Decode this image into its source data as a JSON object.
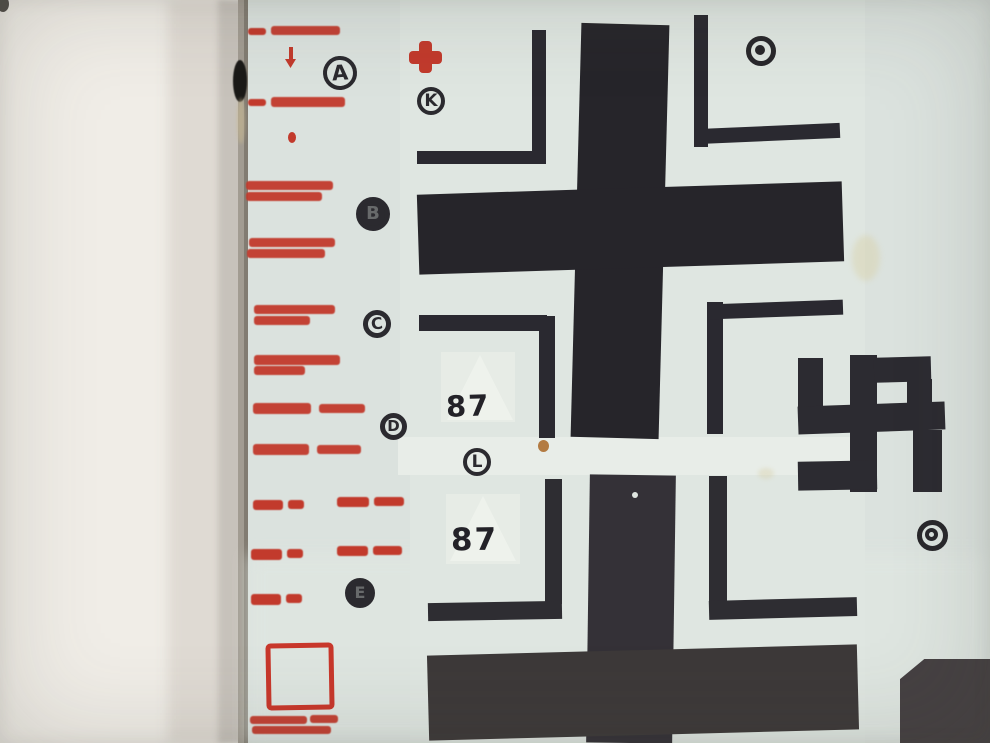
{
  "colors": {
    "wall": "#f0ede7",
    "wall_shadow": "#c7c2bb",
    "sheet_edge": "#a29c92",
    "sheet": "#dbe2de",
    "carrier_film": "#e8ede8",
    "ink_black": "#26252a",
    "ink_black_lower": "#3d3939",
    "ink_red": "#c23a2c",
    "stain_rust": "#ad6e30",
    "stain_yellow": "#d8cfa2"
  },
  "artwork": {
    "shapes": [
      {
        "name": "wall-background",
        "kind": "rect",
        "x": 0,
        "y": 0,
        "w": 990,
        "h": 743,
        "color": "#f0ede7"
      },
      {
        "name": "wall-shadow-soft",
        "kind": "rect",
        "x": 168,
        "y": 0,
        "w": 62,
        "h": 743,
        "color": "#dfdad3",
        "blur": 6
      },
      {
        "name": "wall-shadow-deep",
        "kind": "rect",
        "x": 218,
        "y": 0,
        "w": 26,
        "h": 743,
        "color": "#c7c2bb",
        "blur": 3
      },
      {
        "name": "sheet-edge",
        "kind": "rect",
        "x": 238,
        "y": 0,
        "w": 12,
        "h": 743,
        "color": "#a29c92"
      },
      {
        "name": "sheet-edge-line",
        "kind": "rect",
        "x": 244,
        "y": 0,
        "w": 4,
        "h": 743,
        "color": "#827c72"
      },
      {
        "name": "corner-speck",
        "kind": "ellipse",
        "x": -3,
        "y": -4,
        "w": 12,
        "h": 16,
        "color": "#514e48"
      },
      {
        "name": "decal-sheet",
        "kind": "rect",
        "x": 248,
        "y": 0,
        "w": 742,
        "h": 743,
        "color": "#dbe2de"
      },
      {
        "name": "sheet-bottom-light",
        "kind": "rect",
        "x": 248,
        "y": 555,
        "w": 742,
        "h": 188,
        "color": "#e0e7e2",
        "opacity": 0.7,
        "blur": 8
      },
      {
        "name": "carrier-film-upper",
        "kind": "rect",
        "x": 400,
        "y": 0,
        "w": 465,
        "h": 437,
        "color": "#dfe6e1"
      },
      {
        "name": "carrier-film-band",
        "kind": "rect",
        "x": 398,
        "y": 437,
        "w": 468,
        "h": 38,
        "color": "#e8ede8"
      },
      {
        "name": "carrier-film-lower",
        "kind": "rect",
        "x": 410,
        "y": 475,
        "w": 455,
        "h": 268,
        "color": "#dfe6e1"
      },
      {
        "name": "edge-ink-blob",
        "kind": "ellipse",
        "x": 233,
        "y": 60,
        "w": 14,
        "h": 42,
        "color": "#1b1a18",
        "blur": 0.5
      },
      {
        "name": "edge-stain",
        "kind": "ellipse",
        "x": 237,
        "y": 98,
        "w": 8,
        "h": 46,
        "color": "#c8b88f",
        "opacity": 0.55,
        "blur": 1.5
      },
      {
        "name": "film-patch-87-top",
        "kind": "rect",
        "x": 441,
        "y": 352,
        "w": 74,
        "h": 70,
        "color": "#e7ece6"
      },
      {
        "name": "white-triangle-top",
        "kind": "tri-up",
        "x": 447,
        "y": 355,
        "w": 66,
        "h": 65,
        "color": "#f0f4ee",
        "opacity": 0.8
      },
      {
        "name": "film-patch-87-bottom",
        "kind": "rect",
        "x": 446,
        "y": 494,
        "w": 74,
        "h": 70,
        "color": "#e7ece6"
      },
      {
        "name": "white-triangle-bottom",
        "kind": "tri-up",
        "x": 450,
        "y": 496,
        "w": 66,
        "h": 65,
        "color": "#f0f4ee",
        "opacity": 0.8
      },
      {
        "name": "yellow-stain",
        "kind": "ellipse",
        "x": 852,
        "y": 235,
        "w": 28,
        "h": 46,
        "color": "#d8cfa2",
        "opacity": 0.4,
        "blur": 3
      },
      {
        "name": "yellow-stain-small",
        "kind": "ellipse",
        "x": 758,
        "y": 468,
        "w": 16,
        "h": 11,
        "color": "#d5cba0",
        "opacity": 0.35,
        "blur": 2
      },
      {
        "name": "rust-spot",
        "kind": "ellipse",
        "x": 538,
        "y": 440,
        "w": 11,
        "h": 12,
        "color": "#ad6e30",
        "opacity": 0.9
      },
      {
        "name": "upper-cross-vertical-bar",
        "kind": "rect",
        "x": 576,
        "y": 24,
        "w": 88,
        "h": 414,
        "color": "#26252a",
        "rot": 1.5
      },
      {
        "name": "upper-cross-horizontal-bar",
        "kind": "rect",
        "x": 418,
        "y": 188,
        "w": 425,
        "h": 80,
        "color": "#26252a",
        "rot": -1.8
      },
      {
        "name": "upper-cross-bracket-ul-vert",
        "kind": "rect",
        "x": 532,
        "y": 30,
        "w": 14,
        "h": 134,
        "color": "#2a2930"
      },
      {
        "name": "upper-cross-bracket-ul-horiz",
        "kind": "rect",
        "x": 417,
        "y": 151,
        "w": 129,
        "h": 13,
        "color": "#2a2930"
      },
      {
        "name": "upper-cross-bracket-ur-vert",
        "kind": "rect",
        "x": 694,
        "y": 15,
        "w": 14,
        "h": 132,
        "color": "#2a2930"
      },
      {
        "name": "upper-cross-bracket-ur-horiz",
        "kind": "rect",
        "x": 696,
        "y": 126,
        "w": 144,
        "h": 15,
        "color": "#2a2930",
        "rot": -2.5
      },
      {
        "name": "upper-cross-bracket-ll-horiz",
        "kind": "rect",
        "x": 419,
        "y": 315,
        "w": 128,
        "h": 16,
        "color": "#2a2930"
      },
      {
        "name": "upper-cross-bracket-ll-vert",
        "kind": "rect",
        "x": 539,
        "y": 316,
        "w": 16,
        "h": 122,
        "color": "#2a2930"
      },
      {
        "name": "upper-cross-bracket-lr-vert",
        "kind": "rect",
        "x": 707,
        "y": 302,
        "w": 16,
        "h": 132,
        "color": "#2a2930"
      },
      {
        "name": "upper-cross-bracket-lr-horiz",
        "kind": "rect",
        "x": 709,
        "y": 302,
        "w": 134,
        "h": 15,
        "color": "#2a2930",
        "rot": -2
      },
      {
        "name": "lower-cross-vertical-bar",
        "kind": "rect",
        "x": 588,
        "y": 475,
        "w": 86,
        "h": 268,
        "color": "#343137",
        "rot": 0.8
      },
      {
        "name": "lower-cross-horizontal-bar",
        "kind": "rect",
        "x": 428,
        "y": 650,
        "w": 430,
        "h": 85,
        "color": "#3d3939",
        "rot": -1.5
      },
      {
        "name": "lower-cross-bracket-ul-vert",
        "kind": "rect",
        "x": 545,
        "y": 479,
        "w": 17,
        "h": 125,
        "color": "#2e2d32"
      },
      {
        "name": "lower-cross-bracket-ul-horiz",
        "kind": "rect",
        "x": 428,
        "y": 602,
        "w": 134,
        "h": 18,
        "color": "#2e2d32",
        "rot": -1
      },
      {
        "name": "lower-cross-bracket-ur-vert",
        "kind": "rect",
        "x": 709,
        "y": 476,
        "w": 18,
        "h": 126,
        "color": "#2e2d32"
      },
      {
        "name": "lower-cross-bracket-ur-horiz",
        "kind": "rect",
        "x": 709,
        "y": 599,
        "w": 148,
        "h": 19,
        "color": "#2e2d32",
        "rot": -1.5
      },
      {
        "name": "dust-dot-on-bar",
        "kind": "ellipse",
        "x": 632,
        "y": 492,
        "w": 6,
        "h": 6,
        "color": "#dfe5e0"
      },
      {
        "name": "swastika-left-vertical",
        "kind": "rect",
        "x": 798,
        "y": 358,
        "w": 25,
        "h": 52,
        "color": "#2c2b31"
      },
      {
        "name": "swastika-horizontal-bar",
        "kind": "rect",
        "x": 798,
        "y": 404,
        "w": 147,
        "h": 28,
        "color": "#2c2b31",
        "rot": -2
      },
      {
        "name": "swastika-center-vertical",
        "kind": "rect",
        "x": 850,
        "y": 355,
        "w": 27,
        "h": 137,
        "color": "#2c2b31"
      },
      {
        "name": "swastika-top-arm",
        "kind": "rect",
        "x": 874,
        "y": 357,
        "w": 57,
        "h": 25,
        "color": "#2c2b31",
        "rot": -1.5
      },
      {
        "name": "swastika-right-drop",
        "kind": "rect",
        "x": 907,
        "y": 379,
        "w": 25,
        "h": 50,
        "color": "#2c2b31"
      },
      {
        "name": "swastika-east-hook",
        "kind": "rect",
        "x": 913,
        "y": 430,
        "w": 29,
        "h": 62,
        "color": "#2c2b31"
      },
      {
        "name": "swastika-bottom-arm",
        "kind": "rect",
        "x": 798,
        "y": 461,
        "w": 79,
        "h": 29,
        "color": "#2c2b31",
        "rot": -1
      },
      {
        "name": "corner-black-decal",
        "kind": "rect",
        "x": 900,
        "y": 659,
        "w": 90,
        "h": 84,
        "color": "#454042",
        "clip": "polygon(0 24%, 27% 0, 100% 0, 100% 100%, 0 100%)"
      },
      {
        "name": "red-cross-vertical",
        "kind": "rect",
        "x": 419,
        "y": 41,
        "w": 13,
        "h": 32,
        "color": "#c23a2c",
        "radius": 4
      },
      {
        "name": "red-cross-horizontal",
        "kind": "rect",
        "x": 409,
        "y": 51,
        "w": 33,
        "h": 13,
        "color": "#c23a2c",
        "radius": 4
      },
      {
        "name": "stencil-row1-mark",
        "kind": "rect",
        "x": 248,
        "y": 28,
        "w": 18,
        "h": 7,
        "color": "#c23a2c",
        "radius": 3,
        "blur": 0.4
      },
      {
        "name": "stencil-row1-text",
        "kind": "rect",
        "x": 271,
        "y": 26,
        "w": 69,
        "h": 9,
        "color": "#c23a2c",
        "radius": 3,
        "blur": 0.4,
        "opacity": 0.95
      },
      {
        "name": "red-arrow-stem",
        "kind": "rect",
        "x": 289,
        "y": 47,
        "w": 4,
        "h": 13,
        "color": "#c23a2c"
      },
      {
        "name": "red-arrow-head",
        "kind": "tri-down",
        "x": 285,
        "y": 59,
        "w": 11,
        "h": 9,
        "color": "#c23a2c"
      },
      {
        "name": "stencil-row2-mark",
        "kind": "rect",
        "x": 248,
        "y": 99,
        "w": 18,
        "h": 7,
        "color": "#c23a2c",
        "radius": 3,
        "blur": 0.4
      },
      {
        "name": "stencil-row2-text",
        "kind": "rect",
        "x": 271,
        "y": 97,
        "w": 74,
        "h": 10,
        "color": "#c23a2c",
        "radius": 3,
        "blur": 0.4,
        "opacity": 0.95
      },
      {
        "name": "red-drop-mark",
        "kind": "ellipse",
        "x": 288,
        "y": 132,
        "w": 8,
        "h": 11,
        "color": "#c23a2c"
      },
      {
        "name": "stencil-block1-line1",
        "kind": "rect",
        "x": 246,
        "y": 181,
        "w": 87,
        "h": 9,
        "color": "#c23a2c",
        "radius": 3,
        "blur": 0.4,
        "opacity": 0.95
      },
      {
        "name": "stencil-block1-line2",
        "kind": "rect",
        "x": 246,
        "y": 192,
        "w": 76,
        "h": 9,
        "color": "#c23a2c",
        "radius": 3,
        "blur": 0.4,
        "opacity": 0.95
      },
      {
        "name": "stencil-block2-line1",
        "kind": "rect",
        "x": 249,
        "y": 238,
        "w": 86,
        "h": 9,
        "color": "#c23a2c",
        "radius": 3,
        "blur": 0.4,
        "opacity": 0.95
      },
      {
        "name": "stencil-block2-line2",
        "kind": "rect",
        "x": 247,
        "y": 249,
        "w": 78,
        "h": 9,
        "color": "#c23a2c",
        "radius": 3,
        "blur": 0.4,
        "opacity": 0.95
      },
      {
        "name": "stencil-block3-line1",
        "kind": "rect",
        "x": 254,
        "y": 305,
        "w": 81,
        "h": 9,
        "color": "#c23a2c",
        "radius": 3,
        "blur": 0.4,
        "opacity": 0.95
      },
      {
        "name": "stencil-block3-line2",
        "kind": "rect",
        "x": 254,
        "y": 316,
        "w": 56,
        "h": 9,
        "color": "#c23a2c",
        "radius": 3,
        "blur": 0.4,
        "opacity": 0.95
      },
      {
        "name": "stencil-block4-line1",
        "kind": "rect",
        "x": 254,
        "y": 355,
        "w": 86,
        "h": 10,
        "color": "#c23a2c",
        "radius": 3,
        "blur": 0.4,
        "opacity": 0.95
      },
      {
        "name": "stencil-block4-line2",
        "kind": "rect",
        "x": 254,
        "y": 366,
        "w": 51,
        "h": 9,
        "color": "#c23a2c",
        "radius": 3,
        "blur": 0.4,
        "opacity": 0.95
      },
      {
        "name": "stencil-row5-part1",
        "kind": "rect",
        "x": 253,
        "y": 403,
        "w": 58,
        "h": 11,
        "color": "#c23a2c",
        "radius": 3,
        "blur": 0.4,
        "opacity": 0.95
      },
      {
        "name": "stencil-row5-part2",
        "kind": "rect",
        "x": 319,
        "y": 404,
        "w": 46,
        "h": 9,
        "color": "#c23a2c",
        "radius": 3,
        "blur": 0.4,
        "opacity": 0.95
      },
      {
        "name": "stencil-row6-part1",
        "kind": "rect",
        "x": 253,
        "y": 444,
        "w": 56,
        "h": 11,
        "color": "#c23a2c",
        "radius": 3,
        "blur": 0.4,
        "opacity": 0.95
      },
      {
        "name": "stencil-row6-part2",
        "kind": "rect",
        "x": 317,
        "y": 445,
        "w": 44,
        "h": 9,
        "color": "#c23a2c",
        "radius": 3,
        "blur": 0.4,
        "opacity": 0.95
      },
      {
        "name": "stencil-row7-a",
        "kind": "rect",
        "x": 253,
        "y": 500,
        "w": 30,
        "h": 10,
        "color": "#c23a2c",
        "radius": 3,
        "blur": 0.4
      },
      {
        "name": "stencil-row7-b",
        "kind": "rect",
        "x": 288,
        "y": 500,
        "w": 16,
        "h": 9,
        "color": "#c23a2c",
        "radius": 3,
        "blur": 0.4
      },
      {
        "name": "stencil-row7-c",
        "kind": "rect",
        "x": 337,
        "y": 497,
        "w": 32,
        "h": 10,
        "color": "#c23a2c",
        "radius": 3,
        "blur": 0.4
      },
      {
        "name": "stencil-row7-d",
        "kind": "rect",
        "x": 374,
        "y": 497,
        "w": 30,
        "h": 9,
        "color": "#c23a2c",
        "radius": 3,
        "blur": 0.4
      },
      {
        "name": "stencil-row8-a",
        "kind": "rect",
        "x": 251,
        "y": 549,
        "w": 31,
        "h": 11,
        "color": "#c23a2c",
        "radius": 3,
        "blur": 0.4
      },
      {
        "name": "stencil-row8-b",
        "kind": "rect",
        "x": 287,
        "y": 549,
        "w": 16,
        "h": 9,
        "color": "#c23a2c",
        "radius": 3,
        "blur": 0.4
      },
      {
        "name": "stencil-row8-c",
        "kind": "rect",
        "x": 337,
        "y": 546,
        "w": 31,
        "h": 10,
        "color": "#c23a2c",
        "radius": 3,
        "blur": 0.4
      },
      {
        "name": "stencil-row8-d",
        "kind": "rect",
        "x": 373,
        "y": 546,
        "w": 29,
        "h": 9,
        "color": "#c23a2c",
        "radius": 3,
        "blur": 0.4
      },
      {
        "name": "stencil-row9-a",
        "kind": "rect",
        "x": 251,
        "y": 594,
        "w": 30,
        "h": 11,
        "color": "#c23a2c",
        "radius": 3,
        "blur": 0.4
      },
      {
        "name": "stencil-row9-b",
        "kind": "rect",
        "x": 286,
        "y": 594,
        "w": 16,
        "h": 9,
        "color": "#c23a2c",
        "radius": 3,
        "blur": 0.4
      },
      {
        "name": "stencil-footer-line1a",
        "kind": "rect",
        "x": 250,
        "y": 716,
        "w": 57,
        "h": 8,
        "color": "#c23a2c",
        "radius": 3,
        "blur": 0.4,
        "opacity": 0.95
      },
      {
        "name": "stencil-footer-line1b",
        "kind": "rect",
        "x": 310,
        "y": 715,
        "w": 28,
        "h": 8,
        "color": "#c23a2c",
        "radius": 3,
        "blur": 0.4,
        "opacity": 0.95
      },
      {
        "name": "stencil-footer-line2",
        "kind": "rect",
        "x": 252,
        "y": 726,
        "w": 79,
        "h": 8,
        "color": "#c23a2c",
        "radius": 3,
        "blur": 0.4,
        "opacity": 0.95
      },
      {
        "name": "red-outline-square",
        "kind": "ring",
        "x": 266,
        "y": 643,
        "w": 68,
        "h": 67,
        "color": "#c8372b",
        "bw": 5,
        "radius": 5,
        "rot": -1
      }
    ],
    "circled_letters": [
      {
        "label": "A",
        "x": 323,
        "y": 56,
        "d": 34,
        "bw": 4,
        "fs": 21,
        "filled": false,
        "rot": -4
      },
      {
        "label": "K",
        "x": 417,
        "y": 87,
        "d": 28,
        "bw": 4,
        "fs": 17,
        "filled": false,
        "rot": 0
      },
      {
        "label": "B",
        "x": 356,
        "y": 197,
        "d": 34,
        "bw": 5,
        "fs": 18,
        "filled": true,
        "rot": 0
      },
      {
        "label": "C",
        "x": 363,
        "y": 310,
        "d": 28,
        "bw": 5,
        "fs": 16,
        "filled": false,
        "rot": -6
      },
      {
        "label": "D",
        "x": 380,
        "y": 413,
        "d": 27,
        "bw": 5,
        "fs": 15,
        "filled": false,
        "rot": 0
      },
      {
        "label": "L",
        "x": 463,
        "y": 448,
        "d": 28,
        "bw": 4,
        "fs": 17,
        "filled": false,
        "rot": 0
      },
      {
        "label": "E",
        "x": 345,
        "y": 578,
        "d": 30,
        "bw": 5,
        "fs": 16,
        "filled": true,
        "rot": 0
      }
    ],
    "registration_rings": [
      {
        "name": "ring-mark-top-right",
        "x": 746,
        "y": 36,
        "d": 30,
        "bw": 5,
        "inner": "dot"
      },
      {
        "name": "ring-mark-bottom-right",
        "x": 917,
        "y": 520,
        "d": 31,
        "bw": 5,
        "inner": "ring"
      }
    ],
    "numbers": [
      {
        "text": "87",
        "x": 446,
        "y": 389,
        "fs": 29,
        "rot": -2
      },
      {
        "text": "87",
        "x": 451,
        "y": 522,
        "fs": 31,
        "rot": -1
      }
    ]
  }
}
